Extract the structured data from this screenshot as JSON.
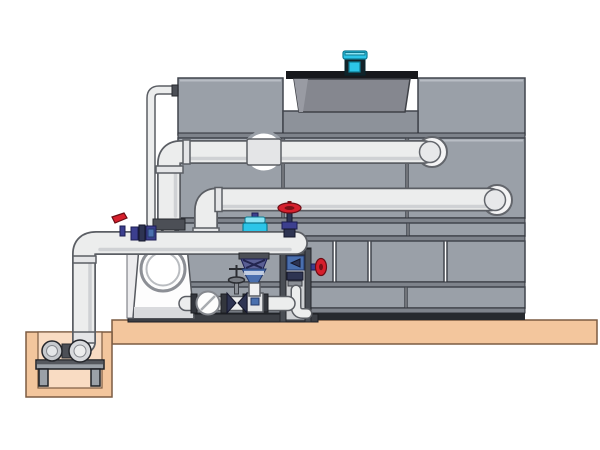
{
  "scene": {
    "subject": "Cooling tower with external piping, circulation pump skid and sump pump pit",
    "type": "technical-illustration",
    "components": [
      "cooling-tower-casing",
      "fan-cowl",
      "fan-motor",
      "upper-distribution-pipe",
      "middle-distribution-pipe",
      "riser-pipe",
      "makeup-water-line",
      "pump-discharge-header",
      "circulation-pump",
      "suction-strainer",
      "gate-valve",
      "check-valve-fitting",
      "globe-valve",
      "control-valve-with-actuator",
      "drain-funnel",
      "valve-frame-column",
      "side-globe-valve",
      "concrete-pad",
      "sump-pit",
      "sump-pump",
      "pump-stand",
      "wall-flanges"
    ]
  },
  "colors": {
    "background": "#ffffff",
    "panel": "#9aa0a8",
    "panel_dark": "#8d929a",
    "panel_stroke": "#41454d",
    "rail": "#7e838b",
    "base_dark": "#26292e",
    "skid_base": "#3c3f45",
    "cowl": "#85878f",
    "cowl_plate": "#17181c",
    "pipe": "#eceded",
    "pipe_outline": "#5b5e64",
    "pipe_shade": "#cfd1d4",
    "sleeve": "#e4e5e7",
    "flange_dark": "#33363d",
    "dark_metal": "#4c4f56",
    "mid_gray": "#8a8e95",
    "white": "#fdfdfd",
    "tan": "#f3c69d",
    "tan_light": "#f9dcc3",
    "tan_stroke": "#7c5c42",
    "cyan": "#2cc5e8",
    "cyan_light": "#8ae4f4",
    "motor_dark": "#142228",
    "navy": "#3c3f8f",
    "navy_dark": "#2e3452",
    "steel_blue": "#4a6fae",
    "red": "#d61f2c",
    "red_dark": "#7a1016",
    "frame_rail": "#4a4e55",
    "frame_back": "#cfd1d4",
    "pump_metal": "#c6c9cd",
    "stand": "#9ba1a8"
  }
}
